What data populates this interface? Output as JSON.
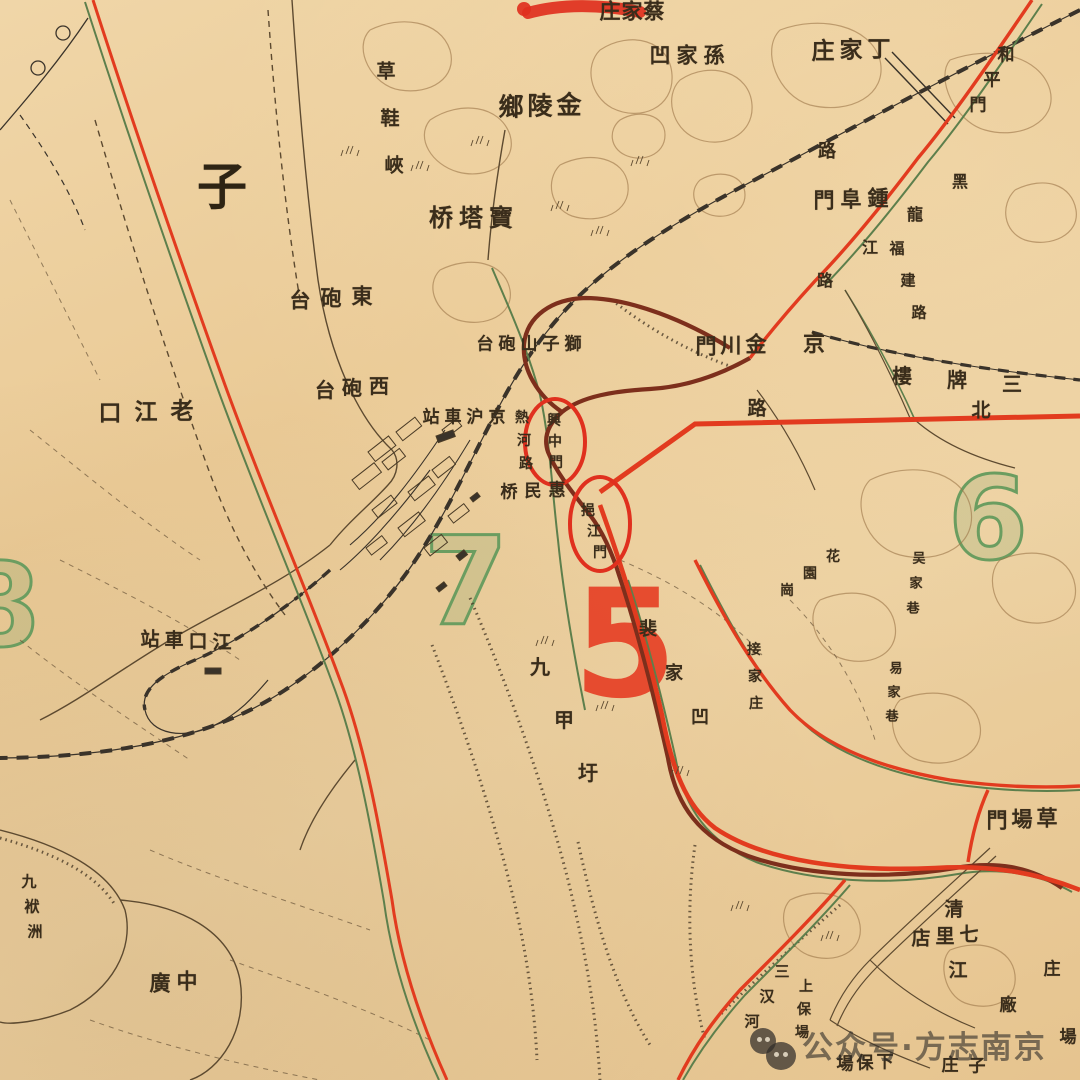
{
  "map_meta": {
    "kind": "historical-city-map",
    "city_area": "Nanjing Xiaguan riverside district",
    "highlighted_gates": [
      "興中門",
      "挹江門"
    ],
    "district_numbers_visible": [
      "5",
      "6",
      "7",
      "8"
    ]
  },
  "palette": {
    "paper": "#ecd0a0",
    "ink": "#3a2d1b",
    "contour": "#9b7447",
    "railway": "#3a332a",
    "red_road": "#e23b1f",
    "city_wall": "#7d2f1c",
    "green_line": "#5d7f4c",
    "number_green": "#6b9d60",
    "number_red": "#e63a20",
    "annotation_red": "#e0301e"
  },
  "map_labels": [
    {
      "name": "label-caijiazhuang",
      "text": "庄家蔡",
      "x": 610,
      "y": 11,
      "dx": 22,
      "dy": 0,
      "s": 21
    },
    {
      "name": "label-sunjiaao",
      "text": "凹家孫",
      "x": 660,
      "y": 55,
      "dx": 27,
      "dy": 0,
      "s": 21
    },
    {
      "name": "label-dingjiazhuang",
      "text": "庄家丁",
      "x": 823,
      "y": 51,
      "dx": 28,
      "dy": -1,
      "s": 23
    },
    {
      "name": "label-jinlingxiang",
      "text": "鄉陵金",
      "x": 511,
      "y": 107,
      "dx": 29,
      "dy": -1,
      "s": 25
    },
    {
      "name": "label-baotaqiao",
      "text": "桥塔寶",
      "x": 441,
      "y": 218,
      "dx": 30,
      "dy": 0,
      "s": 24
    },
    {
      "name": "label-zhongfumen",
      "text": "門阜鍾",
      "x": 824,
      "y": 200,
      "dx": 27,
      "dy": -1,
      "s": 21
    },
    {
      "name": "label-dongpaotai",
      "text": "台砲東",
      "x": 300,
      "y": 300,
      "dx": 31,
      "dy": -2,
      "s": 21
    },
    {
      "name": "label-xipaotai",
      "text": "台砲西",
      "x": 325,
      "y": 390,
      "dx": 27,
      "dy": -2,
      "s": 20
    },
    {
      "name": "label-shizishanpaotai",
      "text": "台砲山子獅",
      "x": 485,
      "y": 345,
      "dx": 22,
      "dy": 0,
      "s": 17
    },
    {
      "name": "label-jinghuchezhan",
      "text": "站車沪京",
      "x": 431,
      "y": 418,
      "dx": 22,
      "dy": 0,
      "s": 17
    },
    {
      "name": "label-huiminqiao",
      "text": "桥民惠",
      "x": 509,
      "y": 493,
      "dx": 24,
      "dy": -1,
      "s": 17
    },
    {
      "name": "label-jinchuanmen",
      "text": "門川金",
      "x": 706,
      "y": 346,
      "dx": 25,
      "dy": -1,
      "s": 21
    },
    {
      "name": "label-jing",
      "text": "京",
      "x": 814,
      "y": 344,
      "dx": 0,
      "dy": 0,
      "s": 22
    },
    {
      "name": "label-lu-mid",
      "text": "路",
      "x": 757,
      "y": 409,
      "dx": 0,
      "dy": 0,
      "s": 19
    },
    {
      "name": "label-lu-top",
      "text": "路",
      "x": 827,
      "y": 152,
      "dx": 0,
      "dy": 0,
      "s": 18
    },
    {
      "name": "label-sanpailou",
      "text": "樓牌三",
      "x": 902,
      "y": 376,
      "dx": 55,
      "dy": 4,
      "s": 20
    },
    {
      "name": "label-bei",
      "text": "北",
      "x": 981,
      "y": 411,
      "dx": 0,
      "dy": 0,
      "s": 19
    },
    {
      "name": "label-laojiangkou",
      "text": "口江老",
      "x": 110,
      "y": 413,
      "dx": 36,
      "dy": -1,
      "s": 23
    },
    {
      "name": "label-jiangkouchezhan",
      "text": "站車口江",
      "x": 150,
      "y": 640,
      "dx": 24,
      "dy": 1,
      "s": 19
    },
    {
      "name": "label-zhongguang",
      "text": "廣中",
      "x": 160,
      "y": 983,
      "dx": 27,
      "dy": -2,
      "s": 21
    },
    {
      "name": "label-caochangmen",
      "text": "門場草",
      "x": 997,
      "y": 820,
      "dx": 25,
      "dy": -1,
      "s": 21
    },
    {
      "name": "label-qilidian",
      "text": "店里七",
      "x": 921,
      "y": 939,
      "dx": 24,
      "dy": -2,
      "s": 19
    },
    {
      "name": "label-qing",
      "text": "清",
      "x": 954,
      "y": 910,
      "dx": 0,
      "dy": 0,
      "s": 19
    },
    {
      "name": "label-jiang",
      "text": "江",
      "x": 958,
      "y": 971,
      "dx": 0,
      "dy": 0,
      "s": 19
    },
    {
      "name": "label-xiabaochang",
      "text": "場保下",
      "x": 845,
      "y": 1065,
      "dx": 20,
      "dy": -1,
      "s": 17
    },
    {
      "name": "label-zhuangzi",
      "text": "庄子",
      "x": 950,
      "y": 1066,
      "dx": 27,
      "dy": 1,
      "s": 17
    },
    {
      "name": "label-zhuang-edge",
      "text": "庄",
      "x": 1052,
      "y": 970,
      "dx": 0,
      "dy": 0,
      "s": 17
    },
    {
      "name": "label-chang-edge",
      "text": "場",
      "x": 1068,
      "y": 1038,
      "dx": 0,
      "dy": 0,
      "s": 17
    },
    {
      "name": "label-chang-factory",
      "text": "廠",
      "x": 1008,
      "y": 1006,
      "dx": 0,
      "dy": 0,
      "s": 17
    },
    {
      "name": "label-zi-large",
      "text": "子",
      "x": 222,
      "y": 187,
      "dx": 0,
      "dy": 0,
      "s": 50,
      "cls": "big-char"
    },
    {
      "name": "label-caoxiexia",
      "text": "草鞋峽",
      "x": 386,
      "y": 72,
      "dx": 4,
      "dy": 47,
      "s": 19
    },
    {
      "name": "label-hepingmen",
      "text": "和平門",
      "x": 1006,
      "y": 56,
      "dx": -14,
      "dy": 25,
      "s": 17
    },
    {
      "name": "label-heilongjianglu",
      "text": "黑龍江路",
      "x": 960,
      "y": 182,
      "dx": -45,
      "dy": 33,
      "s": 16
    },
    {
      "name": "label-fujianlu",
      "text": "福建路",
      "x": 897,
      "y": 249,
      "dx": 11,
      "dy": 32,
      "s": 15
    },
    {
      "name": "label-rehelu",
      "text": "熱河路",
      "x": 522,
      "y": 418,
      "dx": 2,
      "dy": 23,
      "s": 14
    },
    {
      "name": "label-xingzhongmen",
      "text": "興中門",
      "x": 554,
      "y": 421,
      "dx": 1,
      "dy": 21,
      "s": 14
    },
    {
      "name": "label-yijiangmen",
      "text": "挹江門",
      "x": 588,
      "y": 511,
      "dx": 6,
      "dy": 21,
      "s": 14
    },
    {
      "name": "label-jiujiaxu",
      "text": "九甲圩",
      "x": 540,
      "y": 667,
      "dx": 24,
      "dy": 53,
      "s": 20
    },
    {
      "name": "label-peijiaao",
      "text": "裴家凹",
      "x": 648,
      "y": 630,
      "dx": 26,
      "dy": 44,
      "s": 18
    },
    {
      "name": "label-jiejiazhuang",
      "text": "接家庄",
      "x": 754,
      "y": 650,
      "dx": 1,
      "dy": 27,
      "s": 14
    },
    {
      "name": "label-huayuangang",
      "text": "花園崗",
      "x": 833,
      "y": 557,
      "dx": -23,
      "dy": 17,
      "s": 14
    },
    {
      "name": "label-wujiaxiang",
      "text": "吴家巷",
      "x": 919,
      "y": 559,
      "dx": -3,
      "dy": 25,
      "s": 13
    },
    {
      "name": "label-yijiaxiang",
      "text": "易家巷",
      "x": 896,
      "y": 669,
      "dx": -2,
      "dy": 24,
      "s": 13
    },
    {
      "name": "label-jiufuzhou",
      "text": "九袱洲",
      "x": 29,
      "y": 882,
      "dx": 3,
      "dy": 25,
      "s": 15
    },
    {
      "name": "label-sanchahe",
      "text": "三汉河",
      "x": 782,
      "y": 972,
      "dx": -15,
      "dy": 25,
      "s": 15
    },
    {
      "name": "label-shangbaochang",
      "text": "上保場",
      "x": 806,
      "y": 987,
      "dx": -2,
      "dy": 23,
      "s": 14
    }
  ],
  "district_numbers": [
    {
      "name": "district-number-5",
      "text": "5",
      "x": 625,
      "y": 645,
      "s": 150,
      "cls": "num-red"
    },
    {
      "name": "district-number-7",
      "text": "7",
      "x": 466,
      "y": 582,
      "s": 122,
      "cls": "num-green"
    },
    {
      "name": "district-number-6",
      "text": "6",
      "x": 988,
      "y": 520,
      "s": 115,
      "cls": "num-green"
    },
    {
      "name": "district-number-8",
      "text": "8",
      "x": 0,
      "y": 607,
      "s": 115,
      "cls": "num-green"
    }
  ],
  "annotations": {
    "circled_gate_1": "興中門",
    "circled_gate_2": "挹江門",
    "top_red_scribble_over": "蔡家庄"
  },
  "watermark": {
    "text": "公众号·方志南京",
    "logo": "ghost-circles"
  }
}
